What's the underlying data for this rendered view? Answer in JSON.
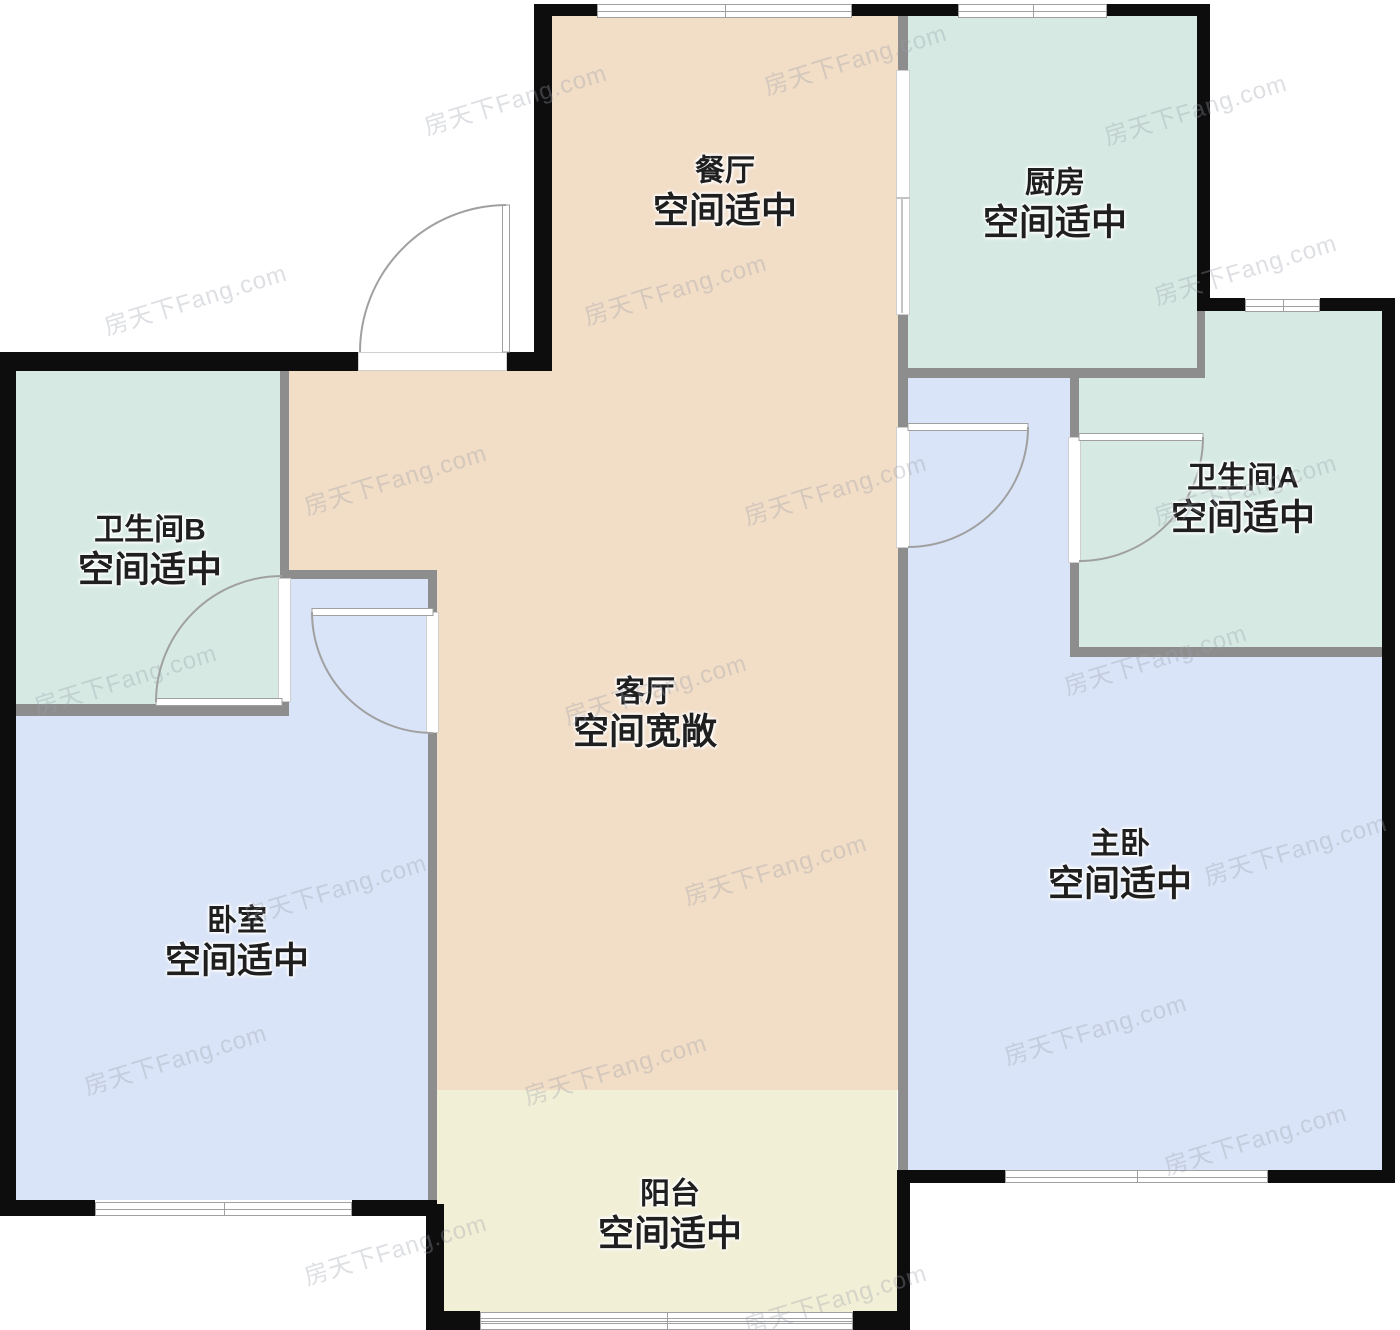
{
  "floorplan": {
    "watermark": "房天下Fang.com",
    "colors": {
      "bg": "#ffffff",
      "peach": "#f2ddc6",
      "teal": "#d6eae3",
      "blue": "#d9e4f8",
      "yellow": "#f1efd6",
      "wall": "#0d0d0d",
      "wallInt": "#8d8d8d",
      "line": "#a0a0a0",
      "label": "#1f1f1f",
      "wm": "#9aa0ab"
    },
    "rooms": [
      {
        "id": "dining",
        "name": "餐厅",
        "note": "空间适中"
      },
      {
        "id": "kitchen",
        "name": "厨房",
        "note": "空间适中"
      },
      {
        "id": "bath_a",
        "name": "卫生间A",
        "note": "空间适中"
      },
      {
        "id": "bath_b",
        "name": "卫生间B",
        "note": "空间适中"
      },
      {
        "id": "living",
        "name": "客厅",
        "note": "空间宽敞"
      },
      {
        "id": "bedroom",
        "name": "卧室",
        "note": "空间适中"
      },
      {
        "id": "master",
        "name": "主卧",
        "note": "空间适中"
      },
      {
        "id": "balcony",
        "name": "阳台",
        "note": "空间适中"
      }
    ]
  }
}
